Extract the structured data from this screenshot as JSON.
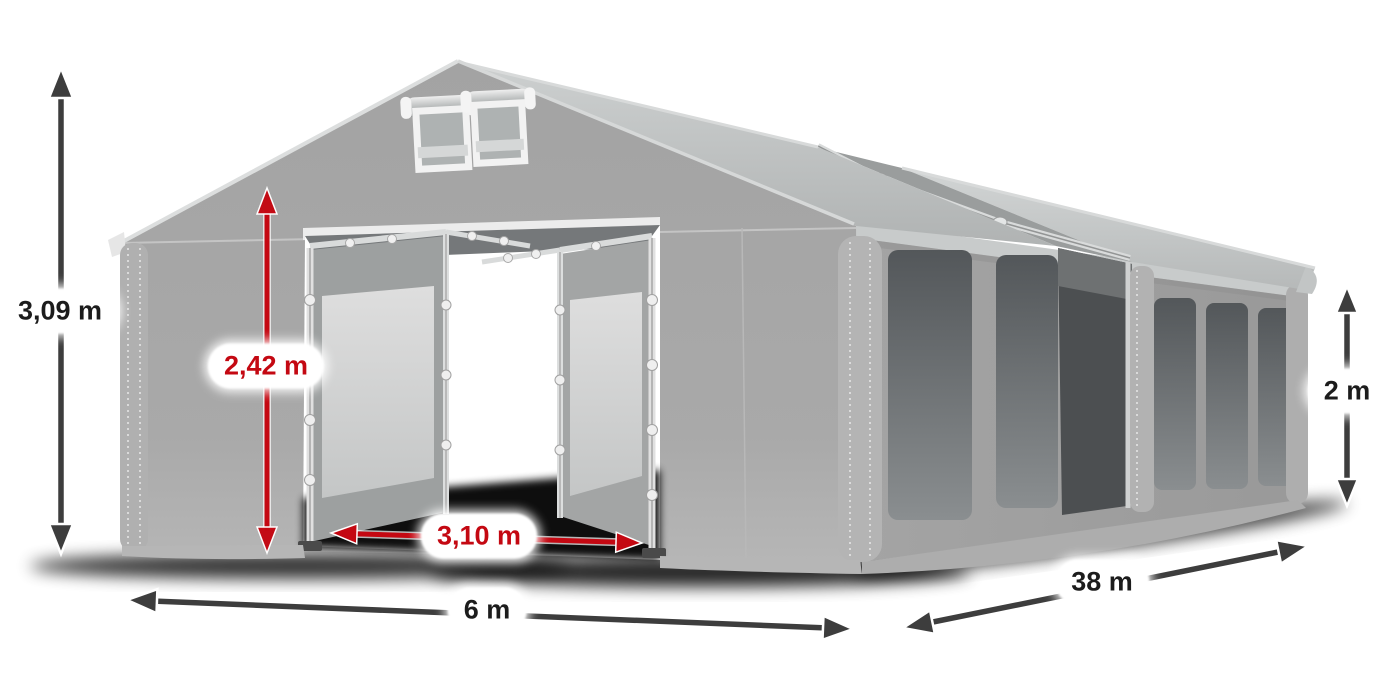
{
  "illustration": {
    "name": "marquee-tent-3d-render",
    "fabric_color": "#a8a8a8",
    "roof_color": "#c3c6c6",
    "side_window_color": "#5c6062",
    "door_window_color": "#d6d6d6",
    "frame_color": "#d9dbdb"
  },
  "annotation_colors": {
    "dark_arrow": "#3d3d3d",
    "red_arrow": "#c40812",
    "label_background": "#ffffff",
    "label_text_dark": "#1c1c1c",
    "label_text_red": "#c40812"
  },
  "dimensions": {
    "total_height": {
      "label": "3,09 m",
      "style": "dark"
    },
    "entrance_height": {
      "label": "2,42 m",
      "style": "red"
    },
    "entrance_width": {
      "label": "3,10 m",
      "style": "red"
    },
    "gable_width": {
      "label": "6 m",
      "style": "dark"
    },
    "length": {
      "label": "38 m",
      "style": "dark"
    },
    "side_wall_height": {
      "label": "2 m",
      "style": "dark"
    }
  }
}
